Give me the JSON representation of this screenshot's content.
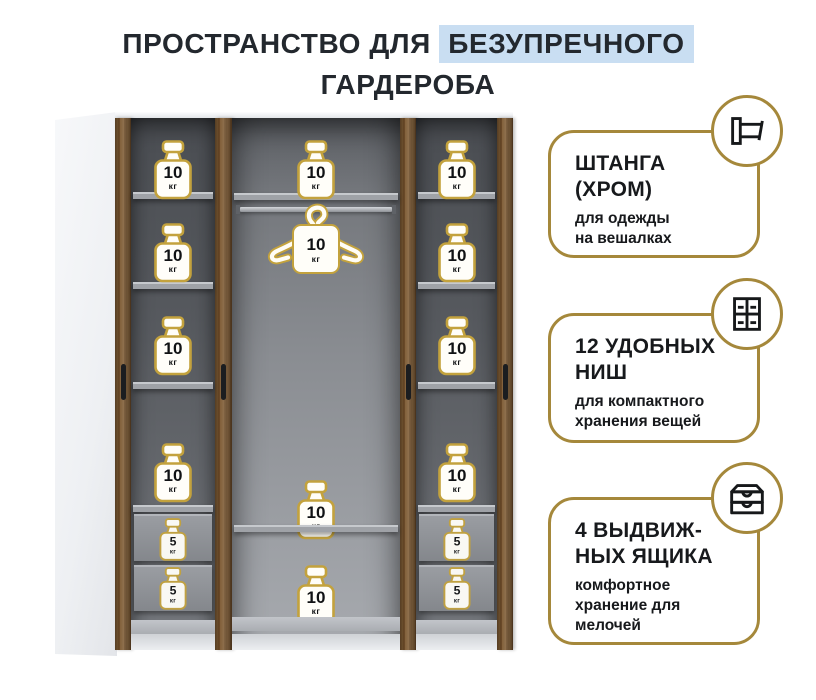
{
  "title": {
    "prefix": "ПРОСТРАНСТВО ДЛЯ",
    "highlight": "БЕЗУПРЕЧНОГО",
    "line2": "ГАРДЕРОБА"
  },
  "wardrobe": {
    "unit": "кг",
    "left_column": {
      "niche_weights": [
        "10",
        "10",
        "10",
        "10"
      ],
      "drawer_weights": [
        "5",
        "5"
      ]
    },
    "middle_column": {
      "top_weight": "10",
      "hanger_weight": "10",
      "lower_weights": [
        "10",
        "10"
      ]
    },
    "right_column": {
      "niche_weights": [
        "10",
        "10",
        "10",
        "10"
      ],
      "drawer_weights": [
        "5",
        "5"
      ]
    }
  },
  "callouts": [
    {
      "icon": "clothes-rail-icon",
      "title_lines": [
        "ШТАНГА",
        "(ХРОМ)"
      ],
      "desc_lines": [
        "для одежды",
        "на вешалках"
      ]
    },
    {
      "icon": "niches-grid-icon",
      "title_lines": [
        "12 УДОБНЫХ",
        "НИШ"
      ],
      "desc_lines": [
        "для компактного",
        "хранения вещей"
      ]
    },
    {
      "icon": "drawers-icon",
      "title_lines": [
        "4 ВЫДВИЖ-",
        "НЫХ ЯЩИКА"
      ],
      "desc_lines": [
        "комфортное",
        "хранение для",
        "мелочей"
      ]
    }
  ],
  "colors": {
    "accent_gold": "#a5883b",
    "badge_gold": "#c3a23d",
    "highlight_blue": "#c9def2",
    "title_color": "#23282e",
    "wood_brown": "#7a5832"
  }
}
